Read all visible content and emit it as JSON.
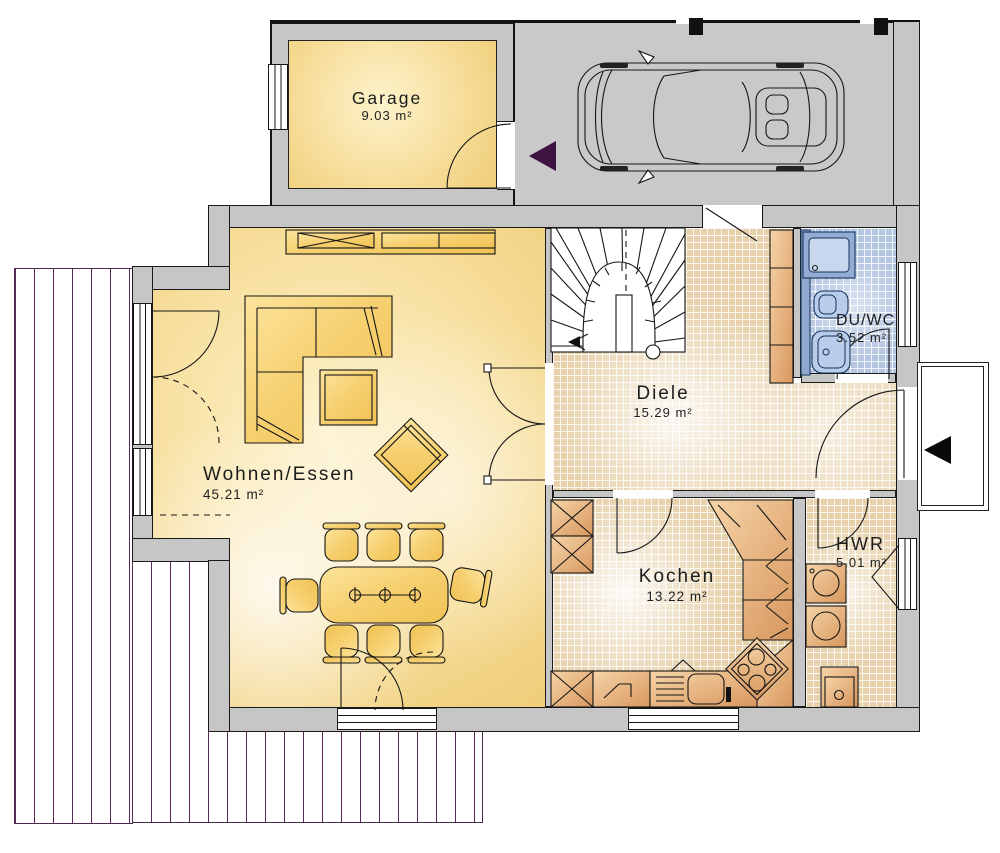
{
  "rooms": {
    "garage": {
      "name": "Garage",
      "area": "9.03 m²"
    },
    "wohnen": {
      "name": "Wohnen/Essen",
      "area": "45.21 m²"
    },
    "diele": {
      "name": "Diele",
      "area": "15.29 m²"
    },
    "duwc": {
      "name": "DU/WC",
      "area": "3.52 m²"
    },
    "kochen": {
      "name": "Kochen",
      "area": "13.22 m²"
    },
    "hwr": {
      "name": "HWR",
      "area": "5.01 m²"
    }
  },
  "colors": {
    "wall": "#c6c6c6",
    "room_yellow": "#f4d88e",
    "tile_beige": "#e7d1ab",
    "tile_blue": "#b5c6e2",
    "furniture_yellow": "#f3c862",
    "wood_orange": "#dfa368",
    "terrace_line": "#5a2a5a",
    "carport_arrow": "#3d1440",
    "entry_arrow": "#0a0a0a"
  }
}
